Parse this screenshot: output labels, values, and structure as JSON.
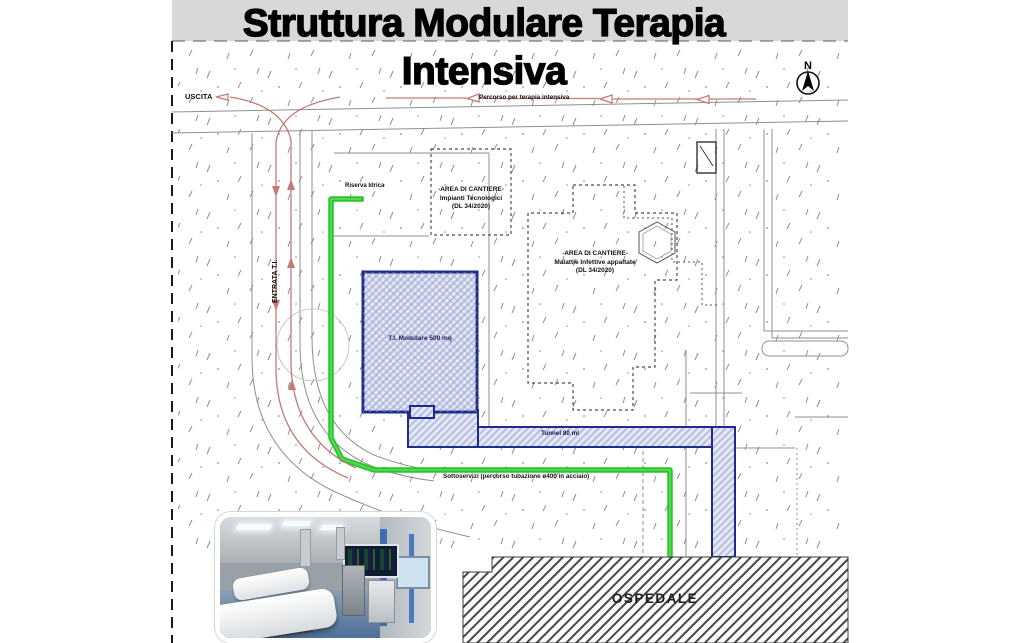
{
  "title": "Struttura Modulare Terapia Intensiva",
  "plan": {
    "north_label": "N",
    "labels": {
      "uscita": "USCITA",
      "entrata": "ENTRATA T.I.",
      "percorso": "Percorso per terapia intensiva",
      "riserva_idrica": "Riserva Idrica",
      "modulo": "T.I. Modulare 500 mq",
      "tunnel": "Tunnel 80 ml",
      "sottoservizi": "Sottoservizi (percorso tubazione ø400 in acciaio)",
      "ospedale": "OSPEDALE"
    },
    "cantiere_impianti": {
      "line1": "-AREA DI CANTIERE-",
      "line2": "Impianti Tecnologici",
      "line3": "(DL 34/2020)"
    },
    "cantiere_malattie": {
      "line1": "-AREA DI CANTIERE-",
      "line2": "Malattie Infettive appaltate",
      "line3": "(DL 34/2020)"
    },
    "colors": {
      "route_green": "#2cc32c",
      "module_blue": "#1e2d8a",
      "route_red": "#c4736f",
      "band_gray": "#d8d8d8"
    }
  }
}
